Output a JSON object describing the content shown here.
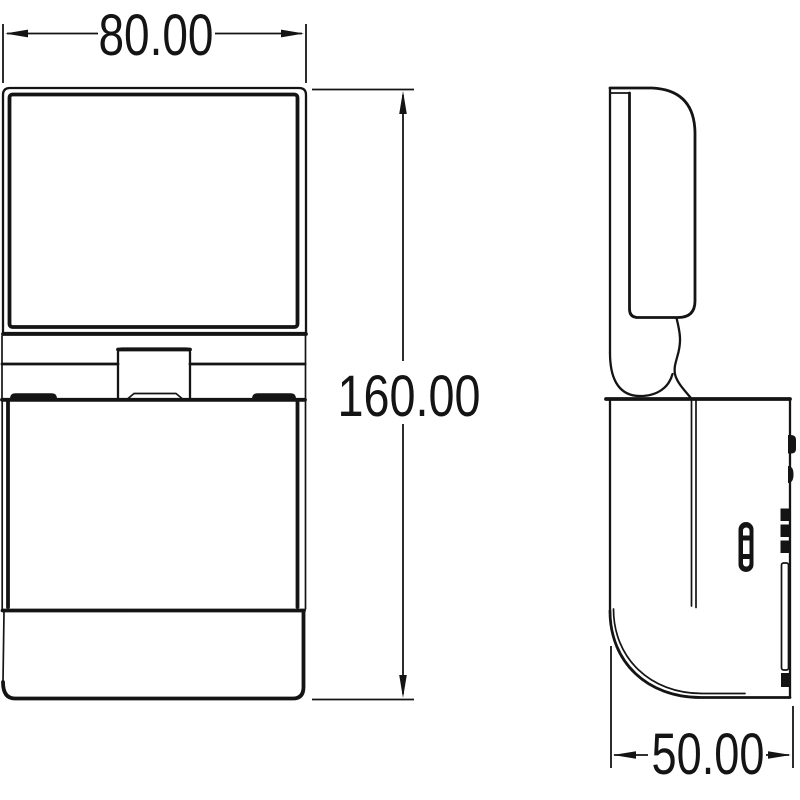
{
  "drawing": {
    "background_color": "#ffffff",
    "line_color": "#141414",
    "dimensions": {
      "width": {
        "value": "80.00"
      },
      "height": {
        "value": "160.00"
      },
      "depth": {
        "value": "50.00"
      }
    }
  }
}
